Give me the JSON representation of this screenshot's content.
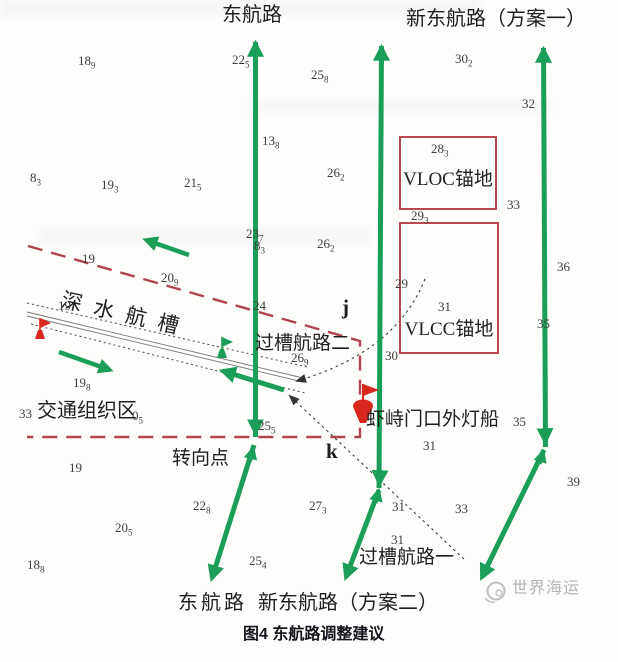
{
  "figure": {
    "caption": "图4 东航路调整建议",
    "watermark": "世界海运"
  },
  "labels": {
    "top_east_route": "东航路",
    "top_new_route_plan1": "新东航路（方案一）",
    "bottom_east_route": "东航路",
    "bottom_new_route_plan2": "新东航路（方案二）",
    "cross_channel_route2": "过槽航路二",
    "cross_channel_route1": "过槽航路一",
    "deep_water_channel": "深水航槽",
    "traffic_organization_zone": "交通组织区",
    "turning_point": "转向点",
    "lightship": "虾峙门口外灯船",
    "vloc_anchorage": "VLOC锚地",
    "vlcc_anchorage": "VLCC锚地",
    "point_j": "j",
    "point_k": "k"
  },
  "colors": {
    "route_green": "#1b9e58",
    "boundary_red": "#b0444e",
    "anchorage_box_red": "#b94850",
    "mark_red": "#d8281e",
    "sounding_gray": "#3d3d3d",
    "watermark_gray": "#b4b4b4"
  },
  "soundings": [
    {
      "main": "18",
      "sub": "9",
      "x": 78,
      "y": 53
    },
    {
      "main": "22",
      "sub": "5",
      "x": 232,
      "y": 52
    },
    {
      "main": "25",
      "sub": "8",
      "x": 311,
      "y": 67
    },
    {
      "main": "30",
      "sub": "2",
      "x": 455,
      "y": 51
    },
    {
      "main": "32",
      "sub": "",
      "x": 522,
      "y": 96
    },
    {
      "main": "13",
      "sub": "8",
      "x": 262,
      "y": 133
    },
    {
      "main": "28",
      "sub": "3",
      "x": 431,
      "y": 141
    },
    {
      "main": "8",
      "sub": "3",
      "x": 30,
      "y": 170
    },
    {
      "main": "19",
      "sub": "3",
      "x": 101,
      "y": 177
    },
    {
      "main": "21",
      "sub": "5",
      "x": 184,
      "y": 175
    },
    {
      "main": "26",
      "sub": "2",
      "x": 327,
      "y": 165
    },
    {
      "main": "33",
      "sub": "",
      "x": 507,
      "y": 197
    },
    {
      "main": "29",
      "sub": "3",
      "x": 411,
      "y": 208
    },
    {
      "main": "23",
      "sub": "7",
      "x": 246,
      "y": 226
    },
    {
      "main": "8",
      "sub": "3",
      "x": 254,
      "y": 238
    },
    {
      "main": "26",
      "sub": "2",
      "x": 317,
      "y": 236
    },
    {
      "main": "19",
      "sub": "",
      "x": 82,
      "y": 251
    },
    {
      "main": "20",
      "sub": "9",
      "x": 161,
      "y": 270
    },
    {
      "main": "36",
      "sub": "",
      "x": 557,
      "y": 259
    },
    {
      "main": "29",
      "sub": "",
      "x": 395,
      "y": 276
    },
    {
      "main": "24",
      "sub": "",
      "x": 253,
      "y": 298
    },
    {
      "main": "31",
      "sub": "",
      "x": 438,
      "y": 299
    },
    {
      "main": "19",
      "sub": "",
      "x": 58,
      "y": 298
    },
    {
      "main": "35",
      "sub": "",
      "x": 537,
      "y": 316
    },
    {
      "main": "30",
      "sub": "",
      "x": 385,
      "y": 348
    },
    {
      "main": "26",
      "sub": "9",
      "x": 291,
      "y": 350
    },
    {
      "main": "19",
      "sub": "8",
      "x": 73,
      "y": 375
    },
    {
      "main": "33",
      "sub": "",
      "x": 19,
      "y": 406
    },
    {
      "main": "0",
      "sub": "5",
      "x": 132,
      "y": 408
    },
    {
      "main": "25",
      "sub": "5",
      "x": 258,
      "y": 418
    },
    {
      "main": "35",
      "sub": "",
      "x": 513,
      "y": 414
    },
    {
      "main": "31",
      "sub": "",
      "x": 423,
      "y": 438
    },
    {
      "main": "19",
      "sub": "",
      "x": 69,
      "y": 460
    },
    {
      "main": "39",
      "sub": "",
      "x": 567,
      "y": 474
    },
    {
      "main": "22",
      "sub": "8",
      "x": 193,
      "y": 498
    },
    {
      "main": "27",
      "sub": "3",
      "x": 309,
      "y": 498
    },
    {
      "main": "31",
      "sub": "",
      "x": 392,
      "y": 499
    },
    {
      "main": "33",
      "sub": "",
      "x": 455,
      "y": 501
    },
    {
      "main": "20",
      "sub": "5",
      "x": 115,
      "y": 520
    },
    {
      "main": "31",
      "sub": "",
      "x": 391,
      "y": 532
    },
    {
      "main": "25",
      "sub": "4",
      "x": 249,
      "y": 553
    },
    {
      "main": "18",
      "sub": "8",
      "x": 27,
      "y": 557
    }
  ]
}
